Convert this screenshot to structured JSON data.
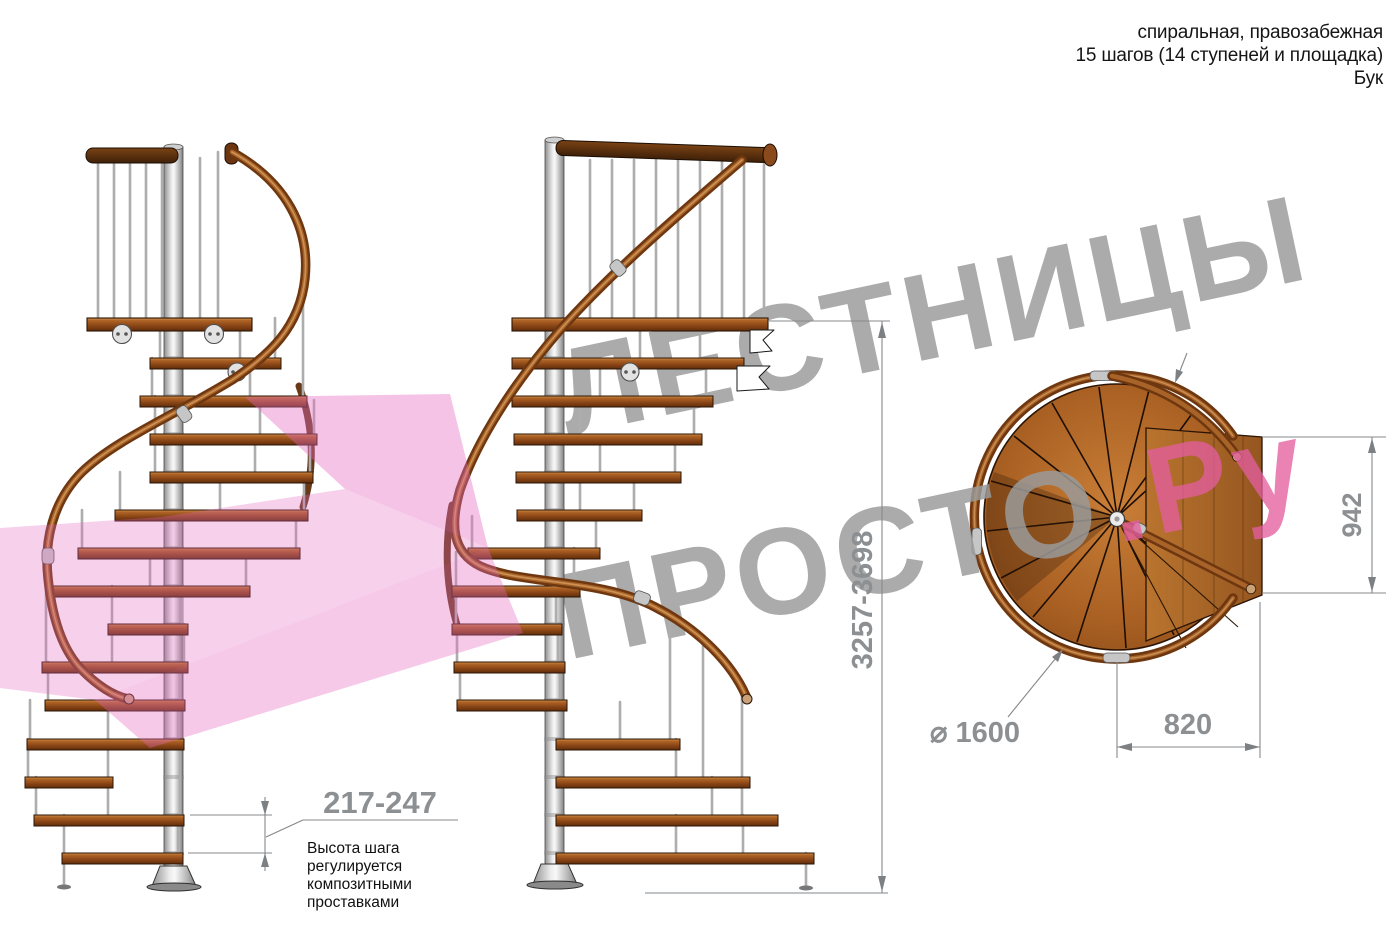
{
  "header": {
    "line1": "спиральная, правозабежная",
    "line2": "15 шагов (14 ступеней и площадка)",
    "line3": "Бук"
  },
  "watermark": {
    "line1": "ЛЕСТНИЦЫ",
    "line2": "ПРОСТО",
    "suffix": ".Ру",
    "gray_color": "#9b9b9b",
    "pink_color": "#e45f9f",
    "arrow_pink": "#e668c0"
  },
  "dimensions": {
    "step_height": "217-247",
    "total_height": "3257-3698",
    "landing_width": "942",
    "landing_depth": "820",
    "diameter": "⌀ 1600"
  },
  "note": {
    "lines": [
      "Высота шага",
      "регулируется",
      "композитными",
      "проставками"
    ]
  },
  "colors": {
    "wood": "#a05a22",
    "dark_wood": "#5a2e0e",
    "metal_pole": "#d9d9d9",
    "dimension_gray": "#8d9093"
  }
}
